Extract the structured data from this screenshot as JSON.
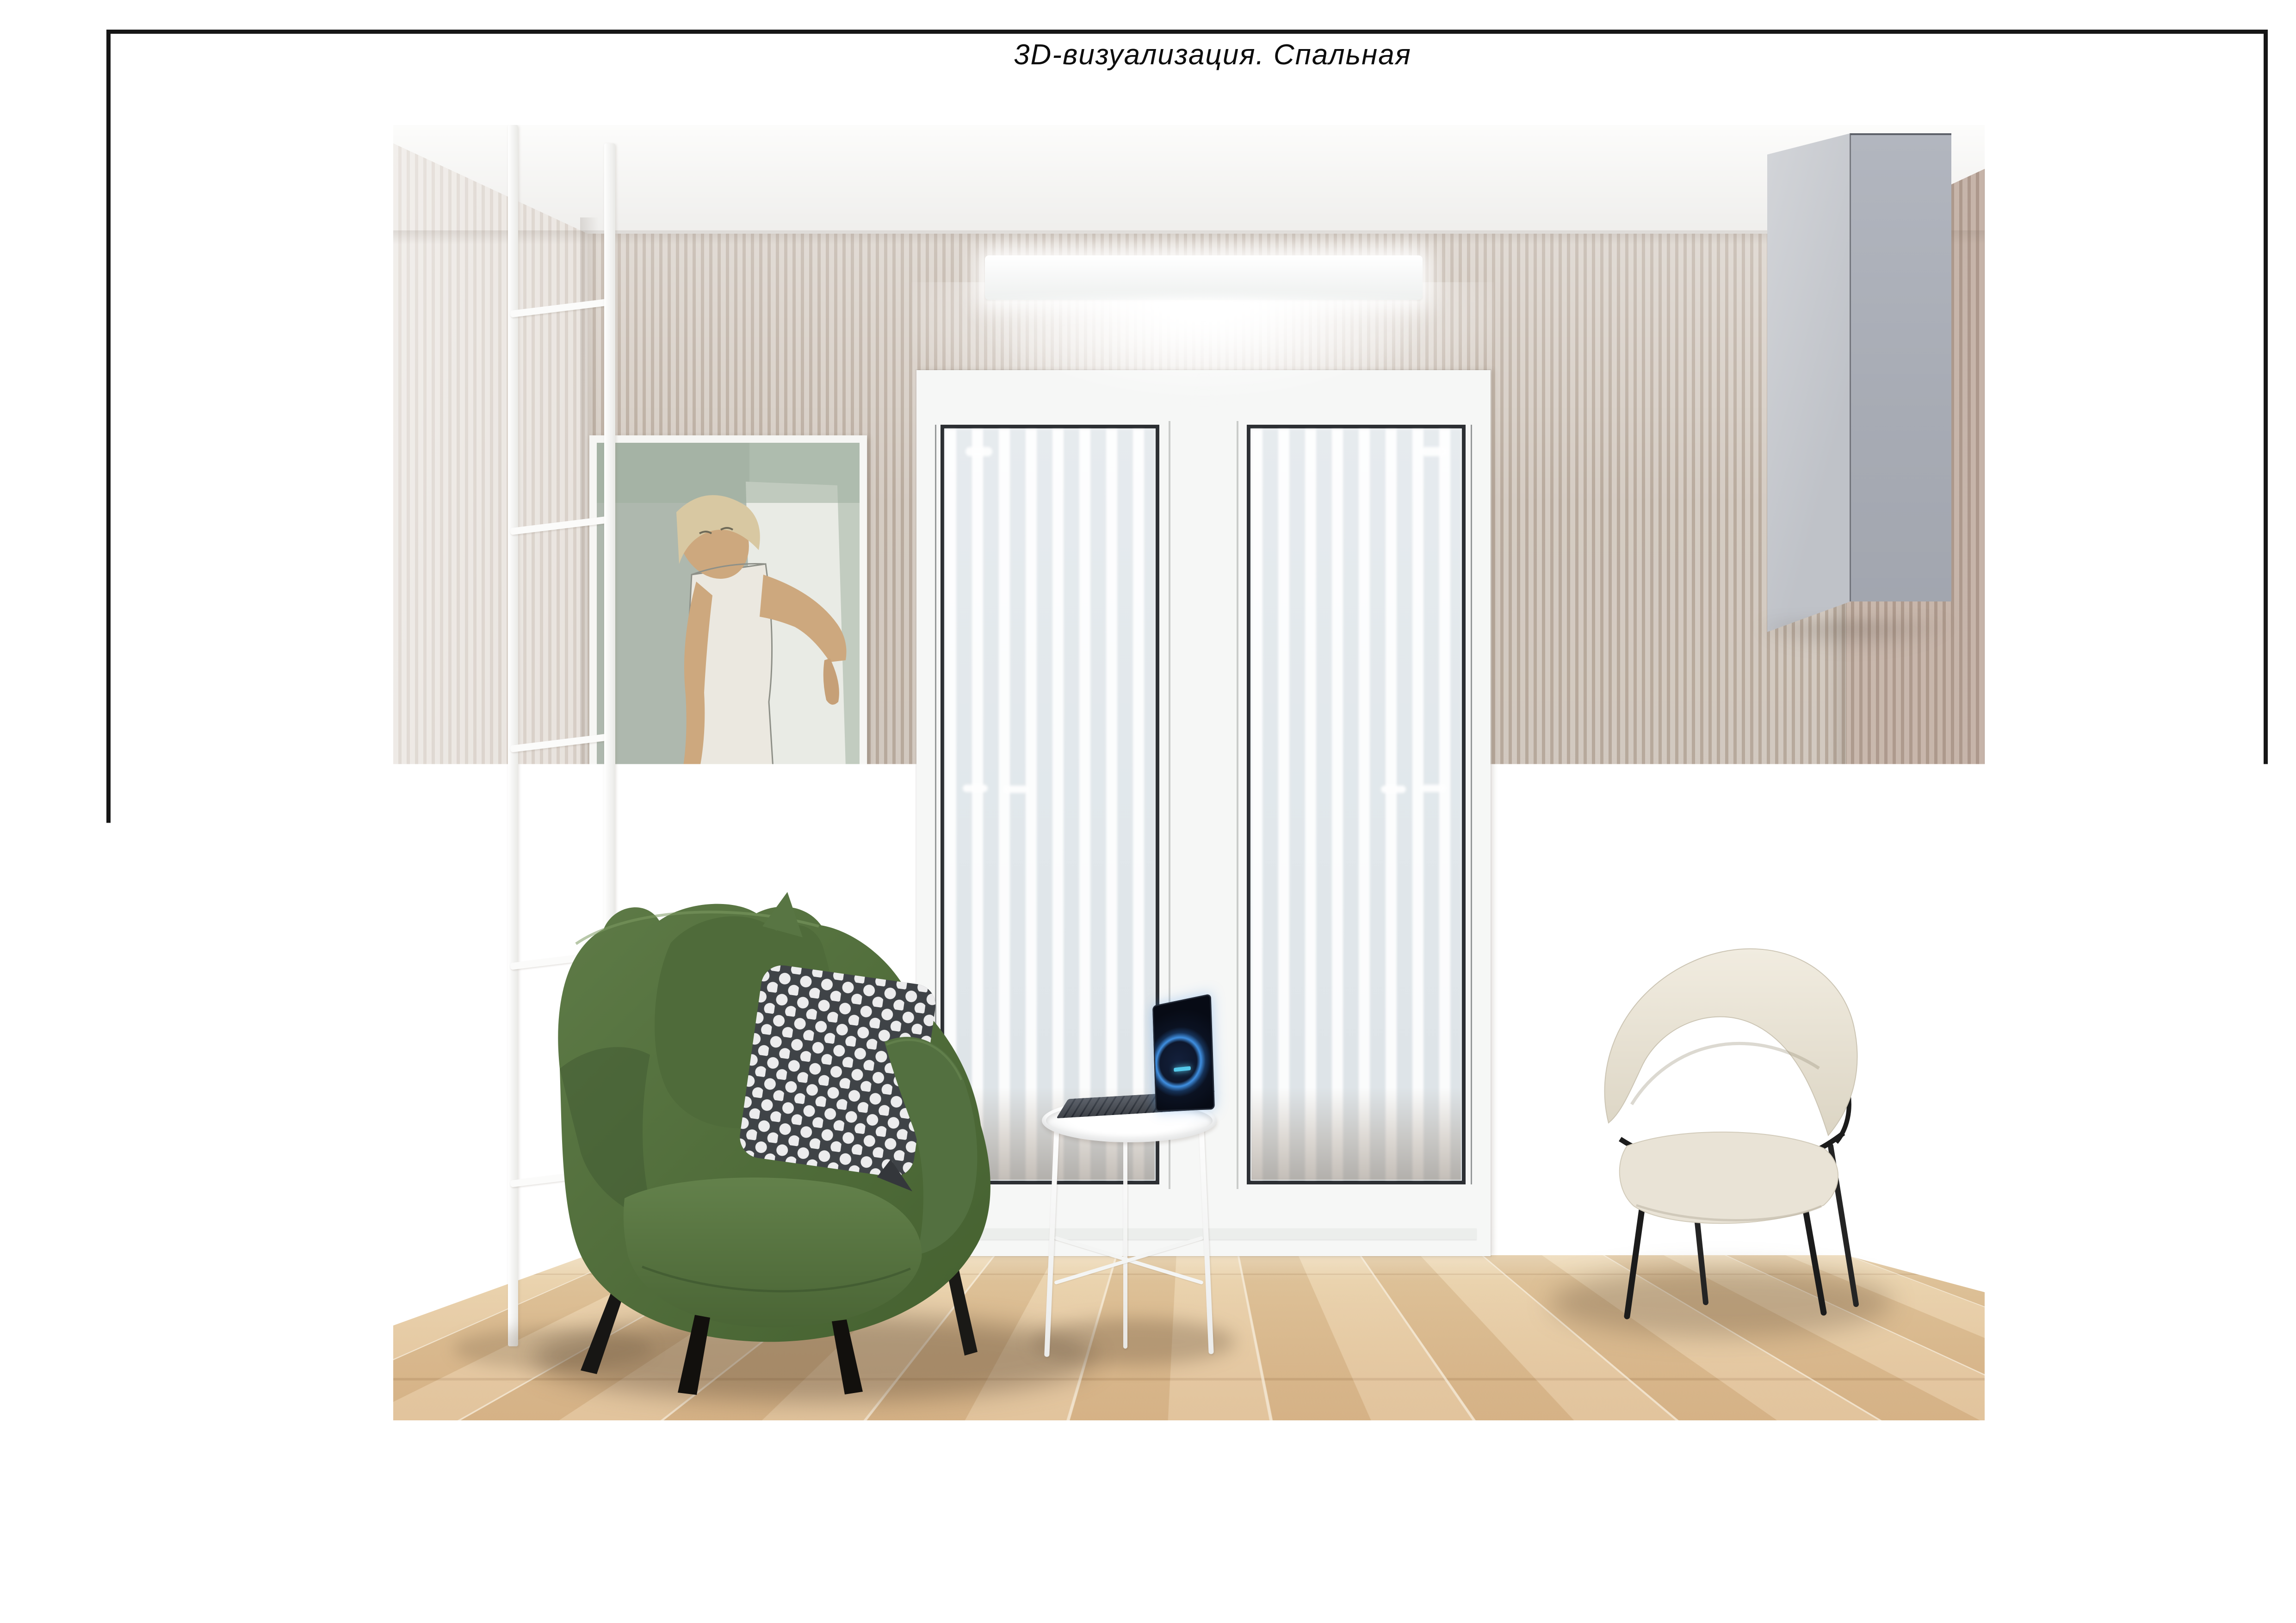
{
  "sheet": {
    "title": "3D-визуализация. Спальная",
    "stamp": {
      "project_address_line1": "Дизайн-проект квартиры по адресу:",
      "project_address_line2": "ул. Братьев Райт, д.Копище, д. 14",
      "drawing_title": "3D-визуализация. Лоджия",
      "roles": [
        {
          "label": "Заказчик",
          "value": ""
        },
        {
          "label": "Дизайнер",
          "value": "Бобко В.А."
        },
        {
          "label": "Архитектор",
          "value": "Бобко В.А."
        }
      ],
      "meta": {
        "headers": [
          "Стадия",
          "Формат",
          "Лист",
          "Масштаб"
        ],
        "values": [
          "ДП",
          "А3",
          "39",
          "1:50"
        ]
      },
      "logo": {
        "text_orange": "Pere",
        "text_black": "plan.by"
      }
    }
  },
  "colors": {
    "logo_accent": "#F6A21C",
    "drawing_lines": "#161616",
    "wall_stripe_light": "#d5ccc3",
    "wall_stripe_dark": "#b9ab9e",
    "floor_wood": "#ddbb8f",
    "armchair_green": "#55713f",
    "polka_pillow_grey": "#41454a",
    "cabinet_grey": "#a7abb4",
    "chair_cream": "#eae4d8",
    "laptop_glow_blue": "#2e7fd8"
  }
}
